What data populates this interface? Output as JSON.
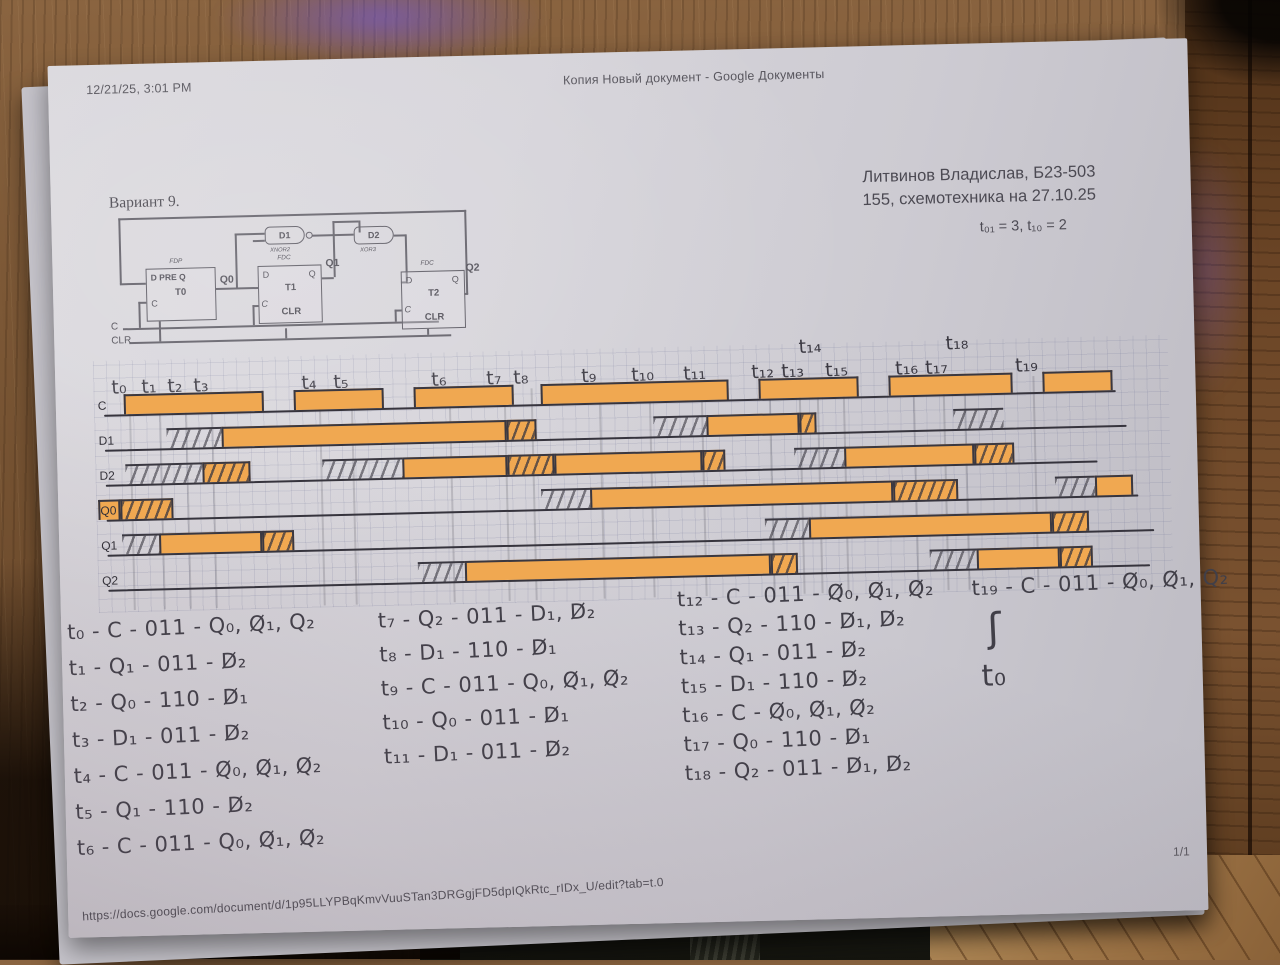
{
  "colors": {
    "highlighter": "#f0a851",
    "pencil": "#413f48",
    "paper": "#d6d4da",
    "wood": "#7c5836"
  },
  "header": {
    "left": "12/21/25, 3:01 PM",
    "center": "Копия Новый документ - Google Документы"
  },
  "variant_label": "Вариант 9.",
  "student": {
    "line1": "Литвинов Владислав, Б23-503",
    "line2": "155, схемотехника на 27.10.25"
  },
  "timing_note": "t₀₁ = 3, t₁₀ = 2",
  "circuit": {
    "ff": [
      {
        "type": "FDP",
        "title": "D PRE Q",
        "name": "T0",
        "clk": "C",
        "out": "Q0"
      },
      {
        "type": "FDC",
        "d": "D",
        "q": "Q",
        "name": "T1",
        "clk": "C",
        "clr": "CLR",
        "out": "Q1"
      },
      {
        "type": "FDC",
        "d": "D",
        "q": "Q",
        "name": "T2",
        "clk": "C",
        "clr": "CLR",
        "out": "Q2"
      }
    ],
    "gates": [
      {
        "name": "D1",
        "type": "XNOR2"
      },
      {
        "name": "D2",
        "type": "XOR3"
      }
    ],
    "inputs": {
      "c": "C",
      "clr": "CLR"
    }
  },
  "chart_data": {
    "type": "timing",
    "signals": [
      "C",
      "D1",
      "D2",
      "Q0",
      "Q1",
      "Q2"
    ],
    "highlight_color": "#f0a851",
    "note": "hand-drawn waveforms, x in px of diagram, hatch = pencil-shaded transition",
    "time_labels": [
      {
        "t": "t₀",
        "x": 68
      },
      {
        "t": "t₁",
        "x": 98
      },
      {
        "t": "t₂",
        "x": 124
      },
      {
        "t": "t₃",
        "x": 150
      },
      {
        "t": "t₄",
        "x": 258
      },
      {
        "t": "t₅",
        "x": 290
      },
      {
        "t": "t₆",
        "x": 388
      },
      {
        "t": "t₇",
        "x": 443
      },
      {
        "t": "t₈",
        "x": 470
      },
      {
        "t": "t₉",
        "x": 538
      },
      {
        "t": "t₁₀",
        "x": 588
      },
      {
        "t": "t₁₁",
        "x": 640
      },
      {
        "t": "t₁₂",
        "x": 708
      },
      {
        "t": "t₁₃",
        "x": 738
      },
      {
        "t": "t₁₄",
        "x": 756,
        "raised": true
      },
      {
        "t": "t₁₅",
        "x": 782
      },
      {
        "t": "t₁₆",
        "x": 852
      },
      {
        "t": "t₁₇",
        "x": 882
      },
      {
        "t": "t₁₈",
        "x": 903,
        "raised": true
      },
      {
        "t": "t₁₉",
        "x": 972
      }
    ],
    "rows": [
      {
        "name": "C",
        "line_end": 1060,
        "segments": [
          [
            68,
            208,
            "solid"
          ],
          [
            238,
            328,
            "solid"
          ],
          [
            358,
            458,
            "solid"
          ],
          [
            485,
            673,
            "solid"
          ],
          [
            703,
            803,
            "solid"
          ],
          [
            833,
            957,
            "solid"
          ],
          [
            987,
            1057,
            "solid"
          ]
        ]
      },
      {
        "name": "D1",
        "line_end": 1070,
        "segments": [
          [
            110,
            165,
            "hatch"
          ],
          [
            165,
            450,
            "solid"
          ],
          [
            450,
            480,
            "solid-hatch"
          ],
          [
            597,
            650,
            "hatch"
          ],
          [
            650,
            743,
            "solid"
          ],
          [
            743,
            760,
            "solid-hatch"
          ],
          [
            897,
            947,
            "hatch"
          ]
        ]
      },
      {
        "name": "D2",
        "line_end": 1040,
        "segments": [
          [
            68,
            145,
            "hatch"
          ],
          [
            145,
            193,
            "solid-hatch"
          ],
          [
            265,
            345,
            "hatch"
          ],
          [
            345,
            450,
            "solid"
          ],
          [
            450,
            497,
            "solid-hatch"
          ],
          [
            497,
            645,
            "solid"
          ],
          [
            645,
            668,
            "solid-hatch"
          ],
          [
            737,
            787,
            "hatch"
          ],
          [
            787,
            917,
            "solid"
          ],
          [
            917,
            957,
            "solid-hatch"
          ]
        ]
      },
      {
        "name": "Q0",
        "line_end": 1080,
        "segments": [
          [
            40,
            62,
            "solid"
          ],
          [
            62,
            115,
            "solid-hatch"
          ],
          [
            483,
            532,
            "hatch"
          ],
          [
            532,
            835,
            "solid"
          ],
          [
            835,
            900,
            "solid-hatch"
          ],
          [
            997,
            1037,
            "hatch"
          ],
          [
            1037,
            1075,
            "solid"
          ]
        ]
      },
      {
        "name": "Q1",
        "line_end": 1095,
        "segments": [
          [
            63,
            100,
            "hatch"
          ],
          [
            100,
            203,
            "solid"
          ],
          [
            203,
            235,
            "solid-hatch"
          ],
          [
            706,
            750,
            "hatch"
          ],
          [
            750,
            993,
            "solid"
          ],
          [
            993,
            1030,
            "solid-hatch"
          ]
        ]
      },
      {
        "name": "Q2",
        "line_end": 1090,
        "segments": [
          [
            358,
            405,
            "hatch"
          ],
          [
            405,
            711,
            "solid"
          ],
          [
            711,
            738,
            "solid-hatch"
          ],
          [
            870,
            917,
            "hatch"
          ],
          [
            917,
            1000,
            "solid"
          ],
          [
            1000,
            1033,
            "solid-hatch"
          ]
        ]
      }
    ]
  },
  "equations": {
    "col1": [
      "t₀ - C - 011 - Q₀, Q̸₁, Q₂",
      "t₁ - Q₁ - 011 - D̸₂",
      "t₂ - Q₀ - 110 - D̸₁",
      "t₃ - D₁ - 011 - D̸₂",
      "t₄ - C - 011 - Q̸₀, Q̸₁, Q̸₂",
      "t₅ - Q₁ - 110 - D̸₂",
      "t₆ - C - 011 - Q₀, Q̸₁, Q̸₂"
    ],
    "col2": [
      "t₇ - Q₂ - 011 - D₁, D̸₂",
      "t₈ - D₁ - 110 - D̸₁",
      "t₉ - C - 011 - Q₀, Q̸₁, Q̸₂",
      "t₁₀ - Q₀ - 011 - D̸₁",
      "t₁₁ - D₁ - 011 - D̸₂"
    ],
    "col3": [
      "t₁₂ - C - 011 - Q̸₀, Q̸₁, Q̸₂",
      "t₁₃ - Q₂ - 110 - D̸₁, D̸₂",
      "t₁₄ - Q₁ - 011 - D̸₂",
      "t₁₅ - D₁ - 110 - D̸₂",
      "t₁₆ - C - Q̸₀, Q̸₁, Q̸₂",
      "t₁₇ - Q₀ - 110 - D̸₁",
      "t₁₈ - Q₂ - 011 - D̸₁, D̸₂"
    ],
    "col4": [
      "t₁₉ - C - 011 - Q̸₀, Q̸₁, Q₂",
      "ʃ",
      "t₀"
    ]
  },
  "footer": {
    "url": "https://docs.google.com/document/d/1p95LLYPBqKmvVuuSTan3DRGgjFD5dpIQkRtc_rIDx_U/edit?tab=t.0",
    "page": "1/1"
  }
}
